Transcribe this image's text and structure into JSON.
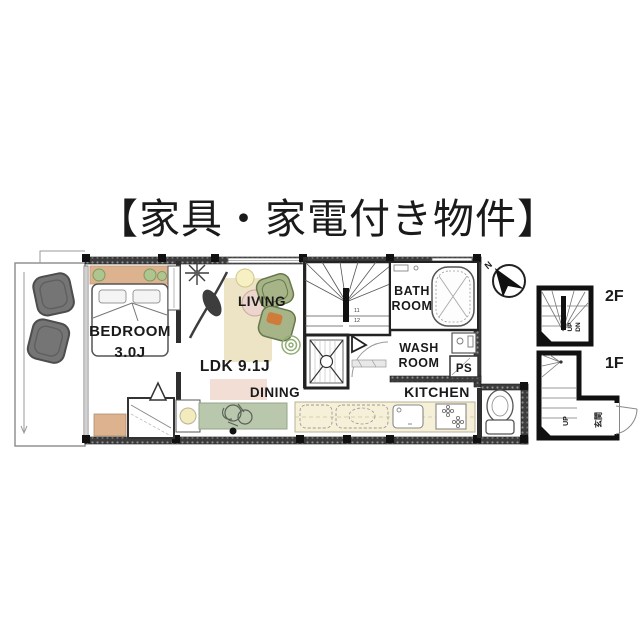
{
  "title": "【家具・家電付き物件】",
  "plan": {
    "bedroom_label": "BEDROOM",
    "bedroom_size": "3.0J",
    "ldk_label": "LDK 9.1J",
    "living_label": "LIVING",
    "dining_label": "DINING",
    "kitchen_label": "KITCHEN",
    "bath_label_1": "BATH",
    "bath_label_2": "ROOM",
    "wash_label_1": "WASH",
    "wash_label_2": "ROOM",
    "ps_label": "PS",
    "compass_north": "N",
    "stair_numbers": [
      "11",
      "12"
    ]
  },
  "insets": {
    "floor2_label": "2F",
    "floor2_up": "UP",
    "floor2_down": "DN",
    "floor1_label": "1F",
    "floor1_up": "UP",
    "floor1_entrance": "玄関"
  },
  "colors": {
    "wall_dark": "#3c3c3c",
    "wood_tan": "#ddb28f",
    "sofa_green": "#a7b488",
    "accent_orange": "#cf7c3a",
    "rug_beige": "#ece4c5",
    "dining_green": "#b9c7ad",
    "counter_cream": "#f6f0d8",
    "chair_gray": "#757575",
    "plant_green": "#93ad76",
    "table_pink": "#ecd5cd",
    "table_yellow": "#f6f0c3"
  }
}
